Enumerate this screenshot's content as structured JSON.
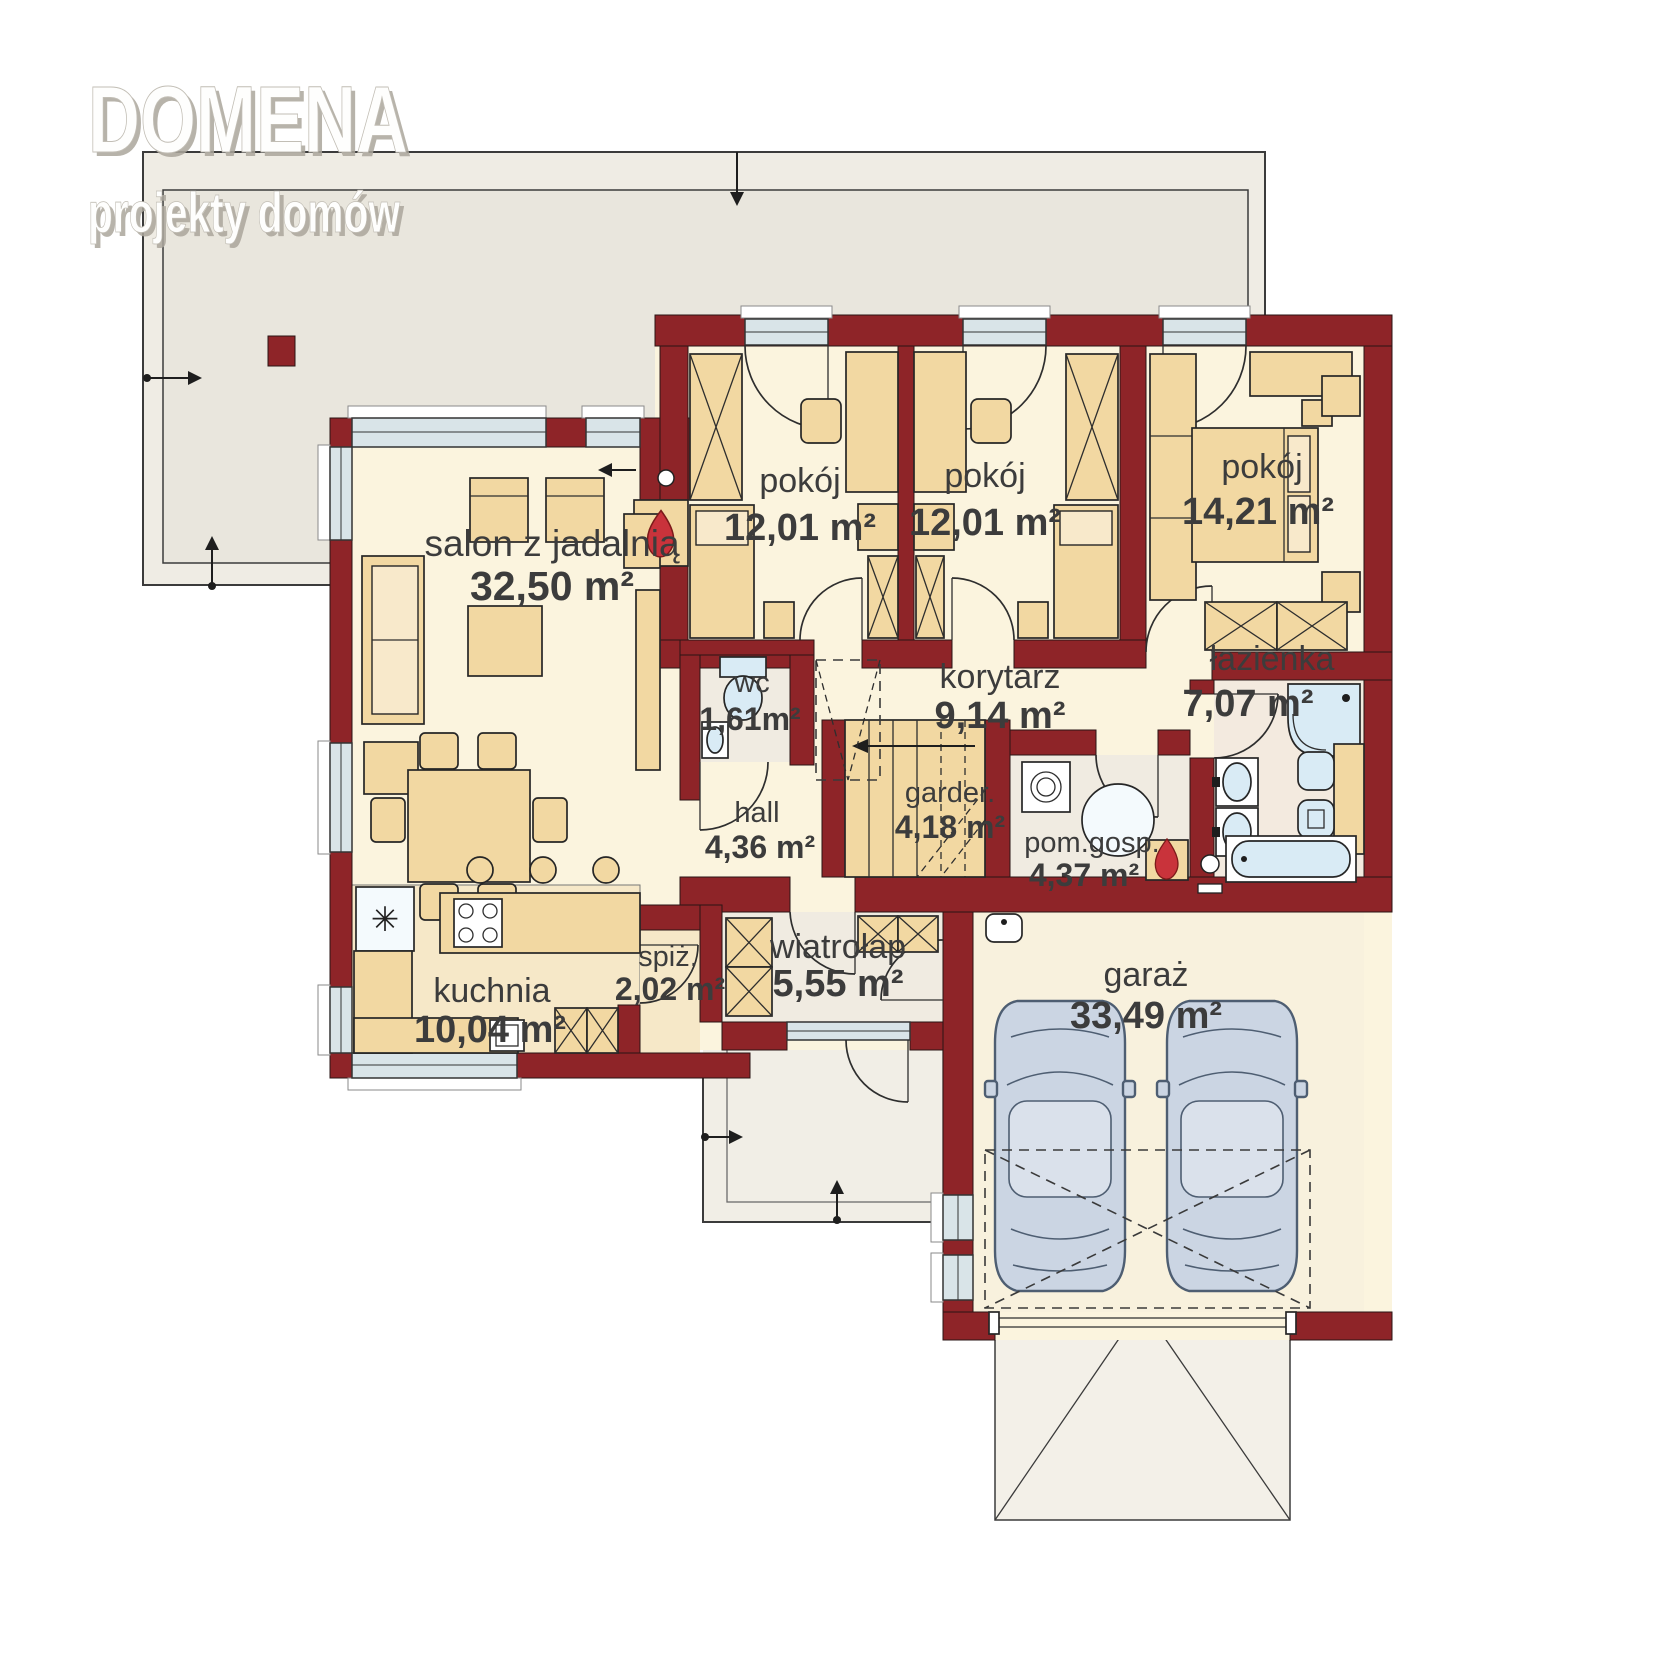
{
  "brand": {
    "name": "DOMENA",
    "tagline": "projekty domów"
  },
  "floorplan": {
    "rooms": {
      "salon": {
        "name": "salon z jadalnią",
        "area": "32,50 m²"
      },
      "pokoj1": {
        "name": "pokój",
        "area": "12,01 m²"
      },
      "pokoj2": {
        "name": "pokój",
        "area": "12,01 m²"
      },
      "pokoj3": {
        "name": "pokój",
        "area": "14,21 m²"
      },
      "korytarz": {
        "name": "korytarz",
        "area": "9,14 m²"
      },
      "lazienka": {
        "name": "łazienka",
        "area": "7,07 m²"
      },
      "wc": {
        "name": "wc",
        "area": "1,61m²"
      },
      "hall": {
        "name": "hall",
        "area": "4,36 m²"
      },
      "garderoba": {
        "name": "garder.",
        "area": "4,18 m²"
      },
      "pomgosp": {
        "name": "pom.gosp.",
        "area": "4,37 m²"
      },
      "kuchnia": {
        "name": "kuchnia",
        "area": "10,04 m²"
      },
      "spizarnia": {
        "name": "spiż.",
        "area": "2,02 m²"
      },
      "wiatrolap": {
        "name": "wiatrołap",
        "area": "5,55 m²"
      },
      "garaz": {
        "name": "garaż",
        "area": "33,49 m²"
      }
    },
    "icons": {
      "fridge_symbol": "✳"
    },
    "colors": {
      "wall": "#8E2428",
      "cream": "#FBF4DE",
      "kitchenFloor": "#F6E8C8",
      "tan": "#F2D8A2",
      "tanLight": "#F8E9CB",
      "grayFloor": "#F0EBE1",
      "bathFloor": "#F3EADF",
      "garageFloor": "#F8F1DD",
      "window": "#D9E4E8",
      "fixture": "#D9EBF5",
      "fixtureLight": "#F4FAFD",
      "terrace": "#E9E6DD",
      "roofArea": "#EFECE4",
      "porch": "#F1EEE6",
      "canopy": "#F3F0E8",
      "car": "#CBD5E3",
      "carRoof": "#DAE1EB",
      "carStroke": "#4E5E72",
      "flame": "#C9333B",
      "ink": "#3C3C3C"
    }
  }
}
